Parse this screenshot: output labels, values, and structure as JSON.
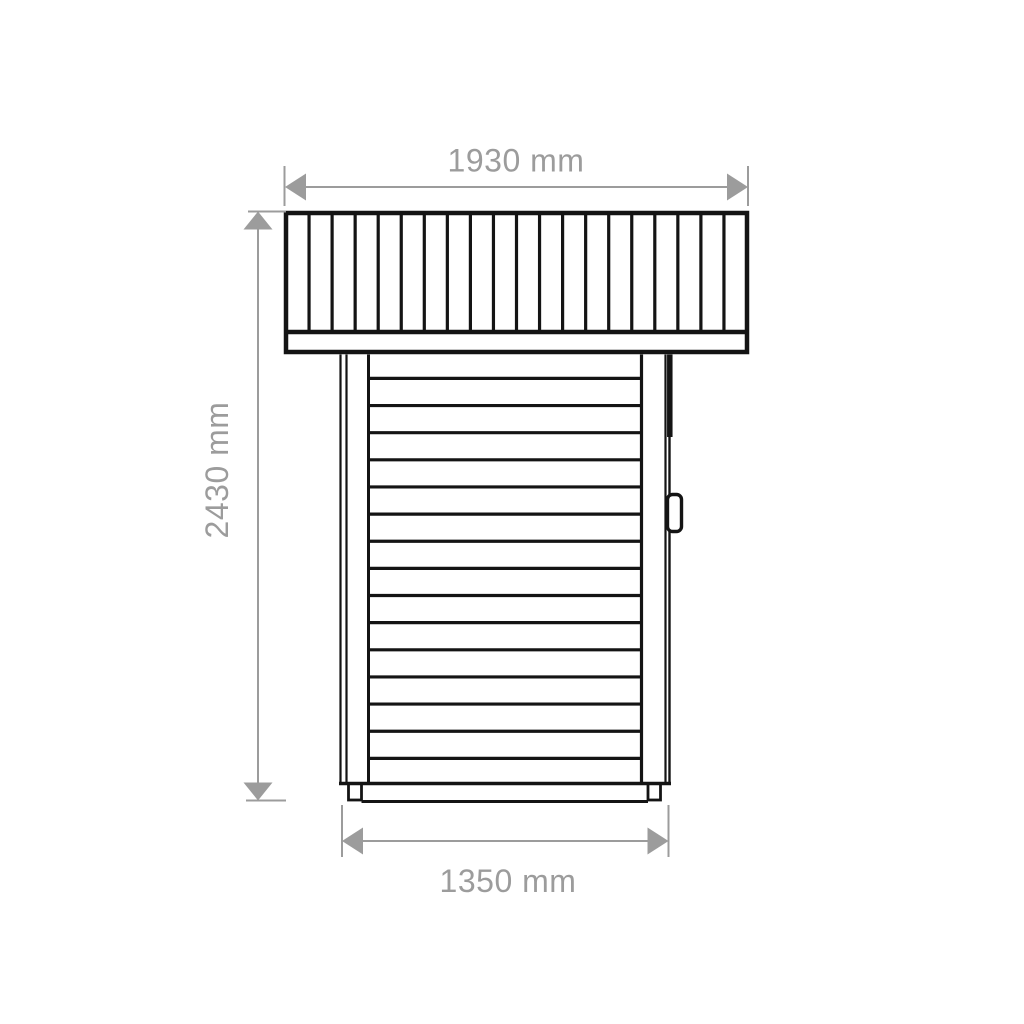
{
  "page": {
    "background": "#ffffff",
    "width": 1024,
    "height": 1024
  },
  "drawing": {
    "subject": "shed-side-elevation-technical-drawing",
    "line_color": "#141414",
    "dim_color": "#9c9c9c",
    "roof": {
      "outer": {
        "x": 286,
        "y": 213,
        "w": 461,
        "h": 139
      },
      "outer_stroke": 4.5,
      "plank_bottom_y": 332,
      "plank_bottom_stroke": 4.5,
      "plank_count": 20,
      "divider_stroke": 3.2
    },
    "wall": {
      "top": 354.5,
      "bottom": 783,
      "verticals": [
        {
          "x": 340.5,
          "w": 2.2,
          "name": "left-corner-outer-line"
        },
        {
          "x": 346.5,
          "w": 2.2,
          "name": "left-corner-shadow-line"
        },
        {
          "x": 368.5,
          "w": 3.0,
          "name": "left-trim-edge-line"
        },
        {
          "x": 641.5,
          "w": 3.2,
          "name": "right-trim-edge-line"
        },
        {
          "x": 665.5,
          "w": 2.2,
          "name": "right-corner-shadow-line"
        },
        {
          "x": 669.5,
          "w": 2.4,
          "name": "right-corner-outer-line"
        }
      ],
      "door_edge_thick": {
        "x": 669.8,
        "y1": 354.5,
        "y2": 437,
        "w": 5.5
      },
      "planks": {
        "x1": 368.5,
        "x2": 641.5,
        "first_y": 378.4,
        "step": 27.14,
        "count": 15,
        "stroke": 3.2
      },
      "bottom_line": {
        "x1": 339,
        "x2": 671,
        "y": 783.5,
        "w": 3.5
      }
    },
    "handle": {
      "x": 667.5,
      "y": 494.5,
      "w": 14,
      "h": 37,
      "rx": 5,
      "stroke": 3.4
    },
    "feet": [
      {
        "x": 348.5,
        "y": 783.5,
        "w": 13,
        "h": 16.5
      },
      {
        "x": 648.0,
        "y": 783.5,
        "w": 12.5,
        "h": 16.5
      }
    ],
    "foot_stroke": 2.8,
    "ground": {
      "x1": 361.5,
      "x2": 648,
      "y": 801.5,
      "w": 3
    },
    "dimensions": {
      "stroke": 2,
      "font_size": 32,
      "top": {
        "label": "1930 mm",
        "line_y": 187,
        "tip1": 285,
        "tip2": 748,
        "arrow_len": 21,
        "arrow_half_w": 13.5,
        "ext": [
          {
            "x": 284.5,
            "y1": 166,
            "y2": 206
          },
          {
            "x": 748,
            "y1": 166,
            "y2": 206
          }
        ]
      },
      "left": {
        "label": "2430 mm",
        "line_x": 258,
        "tip1": 211.5,
        "tip2": 800.5,
        "arrow_len": 18,
        "arrow_half_w": 14.5,
        "ticks": [
          {
            "y": 211.5,
            "x1": 248,
            "x2": 286
          },
          {
            "y": 800.5,
            "x1": 246,
            "x2": 286
          }
        ]
      },
      "bottom": {
        "label": "1350 mm",
        "line_y": 841,
        "tip1": 342,
        "tip2": 668.5,
        "arrow_len": 21,
        "arrow_half_w": 13.5,
        "ext": [
          {
            "x": 342,
            "y1": 805,
            "y2": 857
          },
          {
            "x": 668.5,
            "y1": 805,
            "y2": 857
          }
        ]
      }
    }
  }
}
